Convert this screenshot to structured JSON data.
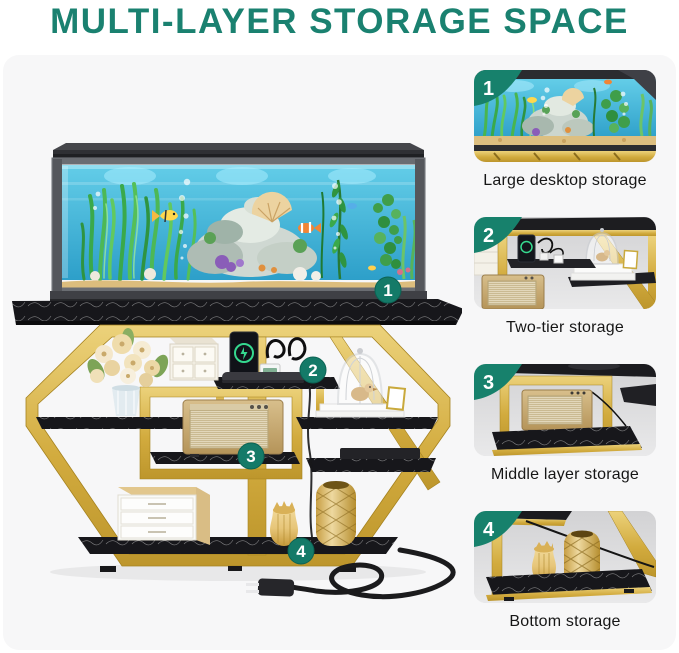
{
  "title": {
    "text": "MULTI-LAYER STORAGE SPACE"
  },
  "main": {
    "badges": [
      {
        "number": "1"
      },
      {
        "number": "2"
      },
      {
        "number": "3"
      },
      {
        "number": "4"
      }
    ]
  },
  "panels": [
    {
      "number": "1",
      "caption": "Large desktop storage",
      "image": "aquarium-closeup"
    },
    {
      "number": "2",
      "caption": "Two-tier storage",
      "image": "two-tier-shelf-closeup"
    },
    {
      "number": "3",
      "caption": "Middle layer storage",
      "image": "middle-shelf-speaker-closeup"
    },
    {
      "number": "4",
      "caption": "Bottom storage",
      "image": "bottom-shelf-vases-closeup"
    }
  ],
  "colors": {
    "accent_teal": "#1a8170",
    "badge_teal": "#147a68",
    "ribbon_teal": "#17816c",
    "gold": "#d2ab3e",
    "gold_dark": "#a5821f",
    "shelf_black": "#17171b",
    "caption_text": "#161616",
    "photo_bg": "#f7f7f8",
    "water_blue": "#41b5dc"
  }
}
